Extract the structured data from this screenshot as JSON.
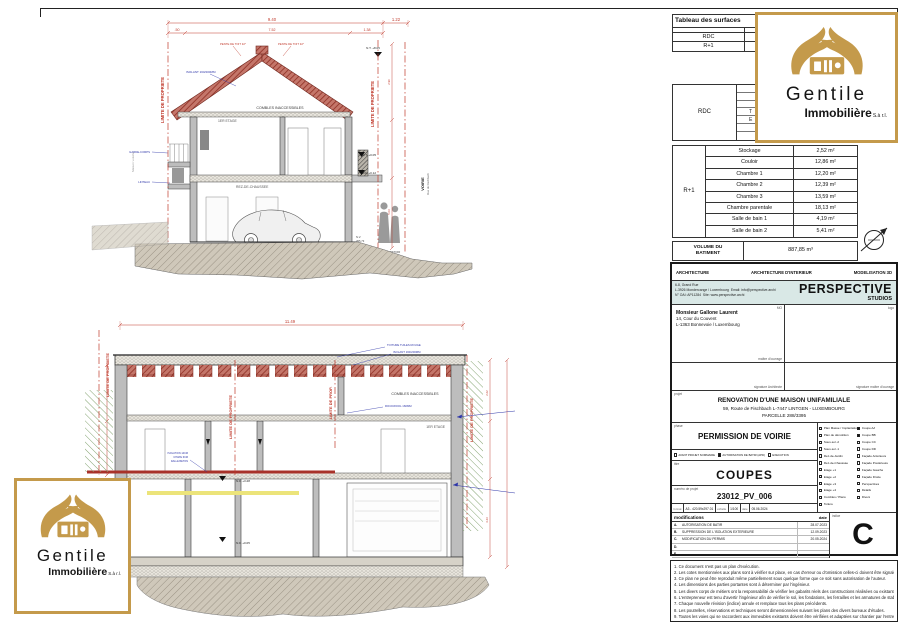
{
  "colors": {
    "gold": "#c49a4b",
    "red": "#b03a2e",
    "annotation_blue": "#2d35a8",
    "teal_band": "#d9e8e6",
    "hatch_green": "#85a472"
  },
  "logo": {
    "name": "Gentile",
    "type": "Immobilière",
    "suffix": "S.à r.l."
  },
  "surface_table1": {
    "title": "Tableau des surfaces",
    "rows": [
      {
        "label": "RDC"
      },
      {
        "label": "R+1"
      }
    ]
  },
  "surface_table2": {
    "row_label": "RDC",
    "fragments": [
      "T",
      "E"
    ]
  },
  "surface_table3": {
    "floor_label": "R+1",
    "rooms": [
      {
        "name": "Stockage",
        "area": "2,52 m²"
      },
      {
        "name": "Couloir",
        "area": "12,86 m²"
      },
      {
        "name": "Chambre 1",
        "area": "12,20 m²"
      },
      {
        "name": "Chambre 2",
        "area": "12,39 m²"
      },
      {
        "name": "Chambre 3",
        "area": "13,59 m²"
      },
      {
        "name": "Chambre parentale",
        "area": "18,13 m²"
      },
      {
        "name": "Salle de bain 1",
        "area": "4,19 m²"
      },
      {
        "name": "Salle de bain 2",
        "area": "5,41 m²"
      }
    ]
  },
  "volume": {
    "label_line1": "VOLUME DU",
    "label_line2": "BATIMENT",
    "value": "887,85 m³"
  },
  "titleblock": {
    "disciplines": [
      "ARCHITECTURE",
      "ARCHITECTURE D'INTERIEUR",
      "MODELISATION 3D"
    ],
    "firm": {
      "address1": "6-8, Grand Rue",
      "address2": "L-3926 Mondercange / Luxembourg",
      "email": "Email: info@perspective.archi",
      "reg": "N° OAI: AP11284",
      "site": "Site: www.perspective.archi",
      "brand": "PERSPECTIVE",
      "brand_sub": "STUDIOS"
    },
    "client": {
      "corner": "MO",
      "name": "Monsieur Gallone Laurent",
      "address1": "14, Cour du Couvent",
      "address2": "L-1363 Bonnevoie / Luxembourg",
      "footer": "maître d'ouvrage"
    },
    "logo_cell_corner": "logo",
    "signatures": {
      "left": "signature Architecte",
      "right": "signature maître d'ouvrage"
    },
    "project": {
      "corner": "projet",
      "line1": "RENOVATION D'UNE MAISON UNIFAMILIALE",
      "line2": "59, Route de Fischbach L-7447 LINTGEN - LUXEMBOURG",
      "line3": "PARCELLE 288/3395"
    },
    "phase": {
      "corner": "phase",
      "title": "PERMISSION DE VOIRIE",
      "checks": [
        {
          "label": "AVANT PROJET SOMMAIRE",
          "checked": false
        },
        {
          "label": "AUTORISATION DE BATIR (APD)",
          "checked": true
        },
        {
          "label": "EXECUTION",
          "checked": false
        }
      ]
    },
    "titre": {
      "corner": "titre",
      "value": "COUPES"
    },
    "numero": {
      "corner": "numéro de projet",
      "value": "23012_PV_006"
    },
    "meta": {
      "format_label": "format",
      "format": "A3 - 420.59x297.01",
      "scale_label": "échelle",
      "scale": "1/100",
      "date_label": "date",
      "date": "05.06.2024"
    },
    "plans_col1": [
      {
        "label": "Plan Masse / Implantation",
        "checked": false
      },
      {
        "label": "Plan de démolition",
        "checked": false
      },
      {
        "label": "Sous-sol -2",
        "checked": false
      },
      {
        "label": "Sous-sol -1",
        "checked": false
      },
      {
        "label": "Rez-de-Jardin",
        "checked": false
      },
      {
        "label": "Rez-de-Chaussée",
        "checked": false
      },
      {
        "label": "Etage +1",
        "checked": false
      },
      {
        "label": "Etage +2",
        "checked": false
      },
      {
        "label": "Etage +3",
        "checked": false
      },
      {
        "label": "Etage +4",
        "checked": false
      },
      {
        "label": "Combles / Plans",
        "checked": false
      },
      {
        "label": "Toiture",
        "checked": false
      }
    ],
    "plans_col2": [
      {
        "label": "Coupe AA",
        "checked": true
      },
      {
        "label": "Coupe BB",
        "checked": true
      },
      {
        "label": "Coupe CC",
        "checked": false
      },
      {
        "label": "Coupe DD",
        "checked": false
      },
      {
        "label": "Façade Antérieure",
        "checked": false
      },
      {
        "label": "Façade Postérieure",
        "checked": false
      },
      {
        "label": "Façade Gauche",
        "checked": false
      },
      {
        "label": "Façade Droite",
        "checked": false
      },
      {
        "label": "Perspectives",
        "checked": false
      },
      {
        "label": "Détails",
        "checked": false
      },
      {
        "label": "Divers",
        "checked": false
      }
    ],
    "modifications": {
      "header": "modifications",
      "date_header": "date",
      "indice_label": "indice",
      "indice": "C",
      "rows": [
        {
          "letter": "A.",
          "label": "AUTORISATION DE BATIR",
          "date": "28.07.2023"
        },
        {
          "letter": "B.",
          "label": "SUPPRESSION DE L'ISOLATION EXTERIEURE",
          "date": "12.09.2023"
        },
        {
          "letter": "C.",
          "label": "MODIFICATION DU PERMIS",
          "date": "20.05.2024"
        },
        {
          "letter": "D.",
          "label": "",
          "date": ""
        },
        {
          "letter": "E.",
          "label": "",
          "date": ""
        }
      ]
    },
    "notes": [
      "1. Ce document n'est pas un plan d'exécution.",
      "2. Les cotes mentionnées aux plans sont à vérifier sur place, en cas d'erreur ou d'omission celles-ci doivent être signalées avant l'exécution des travaux. Les cotes grises sont brutes.",
      "3. Ce plan ne peut être reproduit même partiellement sous quelque forme que ce soit sans autorisation de l'auteur.",
      "4. Les dimensions des parties portantes sont à déterminer par l'ingénieur.",
      "5. Les divers corps de métiers ont la responsabilité de vérifier les gabarits réels des constructions réalisées ou existantes.",
      "6. L'entrepreneur est tenu d'avertir l'ingénieur afin de vérifier le sol, les fondations, les ferrailles et les armatures de stabilité.",
      "7. Chaque nouvelle révision (indice) annule et remplace tous les plans précédents.",
      "8. Les poutrelles, réservations et techniques seront dimensionnées suivant les plans des divers bureaux d'études.",
      "9. Toutes les voies qui se raccordent aux immeubles existants doivent être vérifiées et adaptées sur chantier par l'entreprise."
    ]
  },
  "drawing_top": {
    "dim_overall": "9.40",
    "dim_right": "1.22",
    "dim_a": ".50",
    "dim_b": "7.52",
    "dim_c": "1.38",
    "nt_top": "N.T. +8.05",
    "limite": "LIMITE DE PROPRIETE",
    "pente_left": "PENTE DE TOIT 32°",
    "pente_right": "PENTE DE TOIT 32°",
    "isolant": "ISOLANT 160/200MM",
    "combles": "COMBLES INACCESSIBLES",
    "etage": "1ER ETAGE",
    "rdc": "REZ-DE-CHAUSSEE",
    "garde_corps": "GARDE-CORPS",
    "linteau": "LINTEAU",
    "voisin": "Maison voisine",
    "voirie": "VOIRIE",
    "rue": "Rue de Fischbach",
    "right_nt": "N.T. +0.05",
    "right_nf": "N.F. +0.12",
    "nv": "N.V.",
    "nv_val": "295.73",
    "trottoir": "TROTTOIR",
    "dim_v1": "2.90",
    "dim_v2": "5.03"
  },
  "drawing_bottom": {
    "dim_overall": "11.49",
    "toiture": "TOITURE TUILES ROUGE",
    "isolant": "ISOLANT 160/200MM",
    "rockwool": "ROCKWOOL 160MM",
    "combles": "COMBLES INACCESSIBLES",
    "etage": "1ER ETAGE",
    "rdc": "REZ-DE-CHAUSSEE",
    "iso1": "ISOLATION 14CM",
    "iso2": "CHAPE 6CM",
    "iso3": "DALLE BETON",
    "nf_etage": "N.F. +3.28",
    "nf_rdc": "N.F. +0.05",
    "limite": "LIMITE DE PROPRIETE",
    "limite_mid": "LIMITE DE PROP.",
    "dim_v1": "2.62",
    "dim_v2": "3.23"
  }
}
